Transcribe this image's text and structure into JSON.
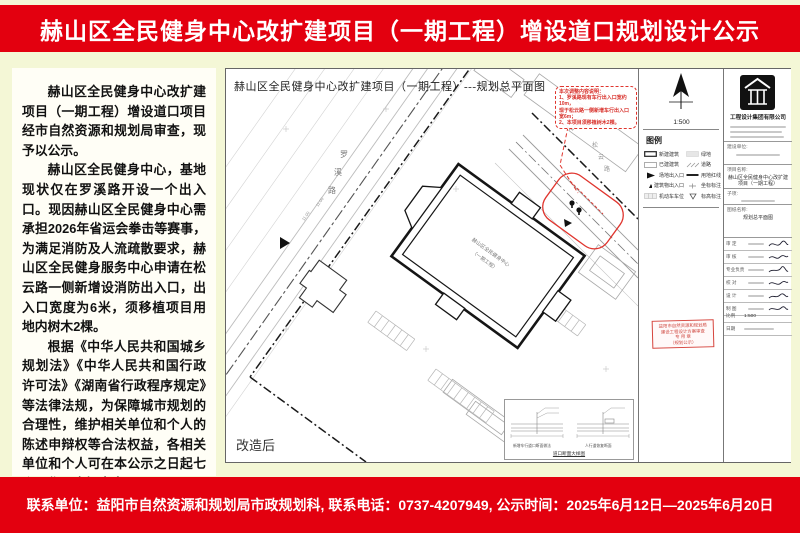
{
  "header": {
    "title": "赫山区全民健身中心改扩建项目（一期工程）增设道口规划设计公示"
  },
  "footer": {
    "text": "联系单位：益阳市自然资源和规划局市政规划科, 联系电话：0737-4207949, 公示时间：2025年6月12日—2025年6月20日"
  },
  "notice": {
    "paragraphs": [
      "赫山区全民健身中心改扩建项目（一期工程）增设道口项目经市自然资源和规划局审查，现予以公示。",
      "赫山区全民健身中心，基地现状仅在罗溪路开设一个出入口。现因赫山区全民健身中心需承担2026年省运会拳击等赛事，为满足消防及人流疏散要求，赫山区全民健身服务中心申请在松云路一侧新增设消防出入口，出入口宽度为6米，须移植项目用地内树木2棵。",
      "根据《中华人民共和国城乡规划法》《中华人民共和国行政许可法》《湖南省行政程序规定》等法律法规，为保障城市规划的合理性，维护相关单位和个人的陈述申辩权等合法权益，各相关单位和个人可在本公示之日起七个工作日内提出意见。"
    ]
  },
  "drawing": {
    "title": "赫山区全民健身中心改扩建项目（一期工程）---规划总平面图",
    "after_label": "改造后",
    "scale": "1:500",
    "road_luoxi_chars": [
      "罗",
      "溪",
      "路"
    ],
    "road_songyun_chars": [
      "松",
      "云",
      "路"
    ],
    "main_building": [
      "赫山区全民健身中心",
      "（一期工程）"
    ],
    "dims": [
      "11.00",
      "11.00"
    ],
    "note_box": {
      "title": "本次调整内容说明：",
      "lines": [
        "1、罗溪路现有车行出入口宽约10m，",
        "现于松云路一侧新增车行出入口宽6m；",
        "2、本项目须移植树木2棵。"
      ]
    },
    "legend": {
      "title": "图例",
      "items_left": [
        "新建建筑",
        "已建建筑",
        "场地出入口",
        "建筑物出入口",
        "机动车车位"
      ],
      "items_right": [
        "绿地",
        "道路",
        "用地红线",
        "坐标标注",
        "标高标注"
      ]
    },
    "inset": {
      "left_caption": "新增车行道口断面做法",
      "right_caption": "人行道恢复断面",
      "title": "道口断面大样图"
    },
    "stamp": {
      "lines": [
        "益阳市自然资源和规划局",
        "建设工程设计方案审查",
        "专 用 章",
        "（规划公示）"
      ]
    },
    "titleblock": {
      "company": "工程设计集团有限公司",
      "fields": [
        {
          "label": "建设单位:",
          "value": ""
        },
        {
          "label": "项目名称:",
          "value": "赫山区全民健身中心改扩建项目（一期工程）"
        },
        {
          "label": "子项:",
          "value": ""
        },
        {
          "label": "图纸名称:",
          "value": "规划总平面图"
        }
      ],
      "sign_rows": [
        "审 定",
        "审 核",
        "专业负责",
        "校 对",
        "设 计",
        "制 图"
      ],
      "scale_label": "比例",
      "scale_value": "1:500",
      "date_label": "日期"
    }
  }
}
